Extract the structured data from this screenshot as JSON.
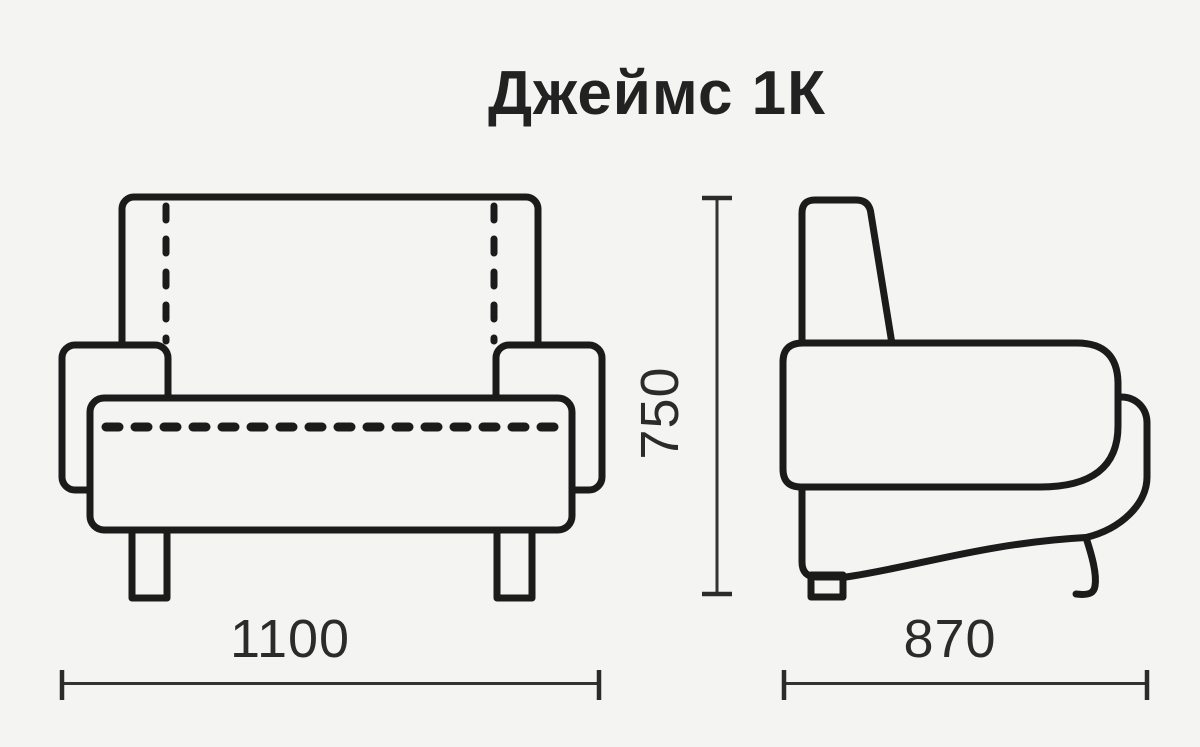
{
  "title": "Джеймс 1К",
  "dimension_labels": {
    "width": "1100",
    "height": "750",
    "depth": "870"
  },
  "colors": {
    "background": "#f4f4f3",
    "drawing_line": "#1b1b1b",
    "dimension_line": "#333333",
    "text": "#2b2b2b"
  }
}
